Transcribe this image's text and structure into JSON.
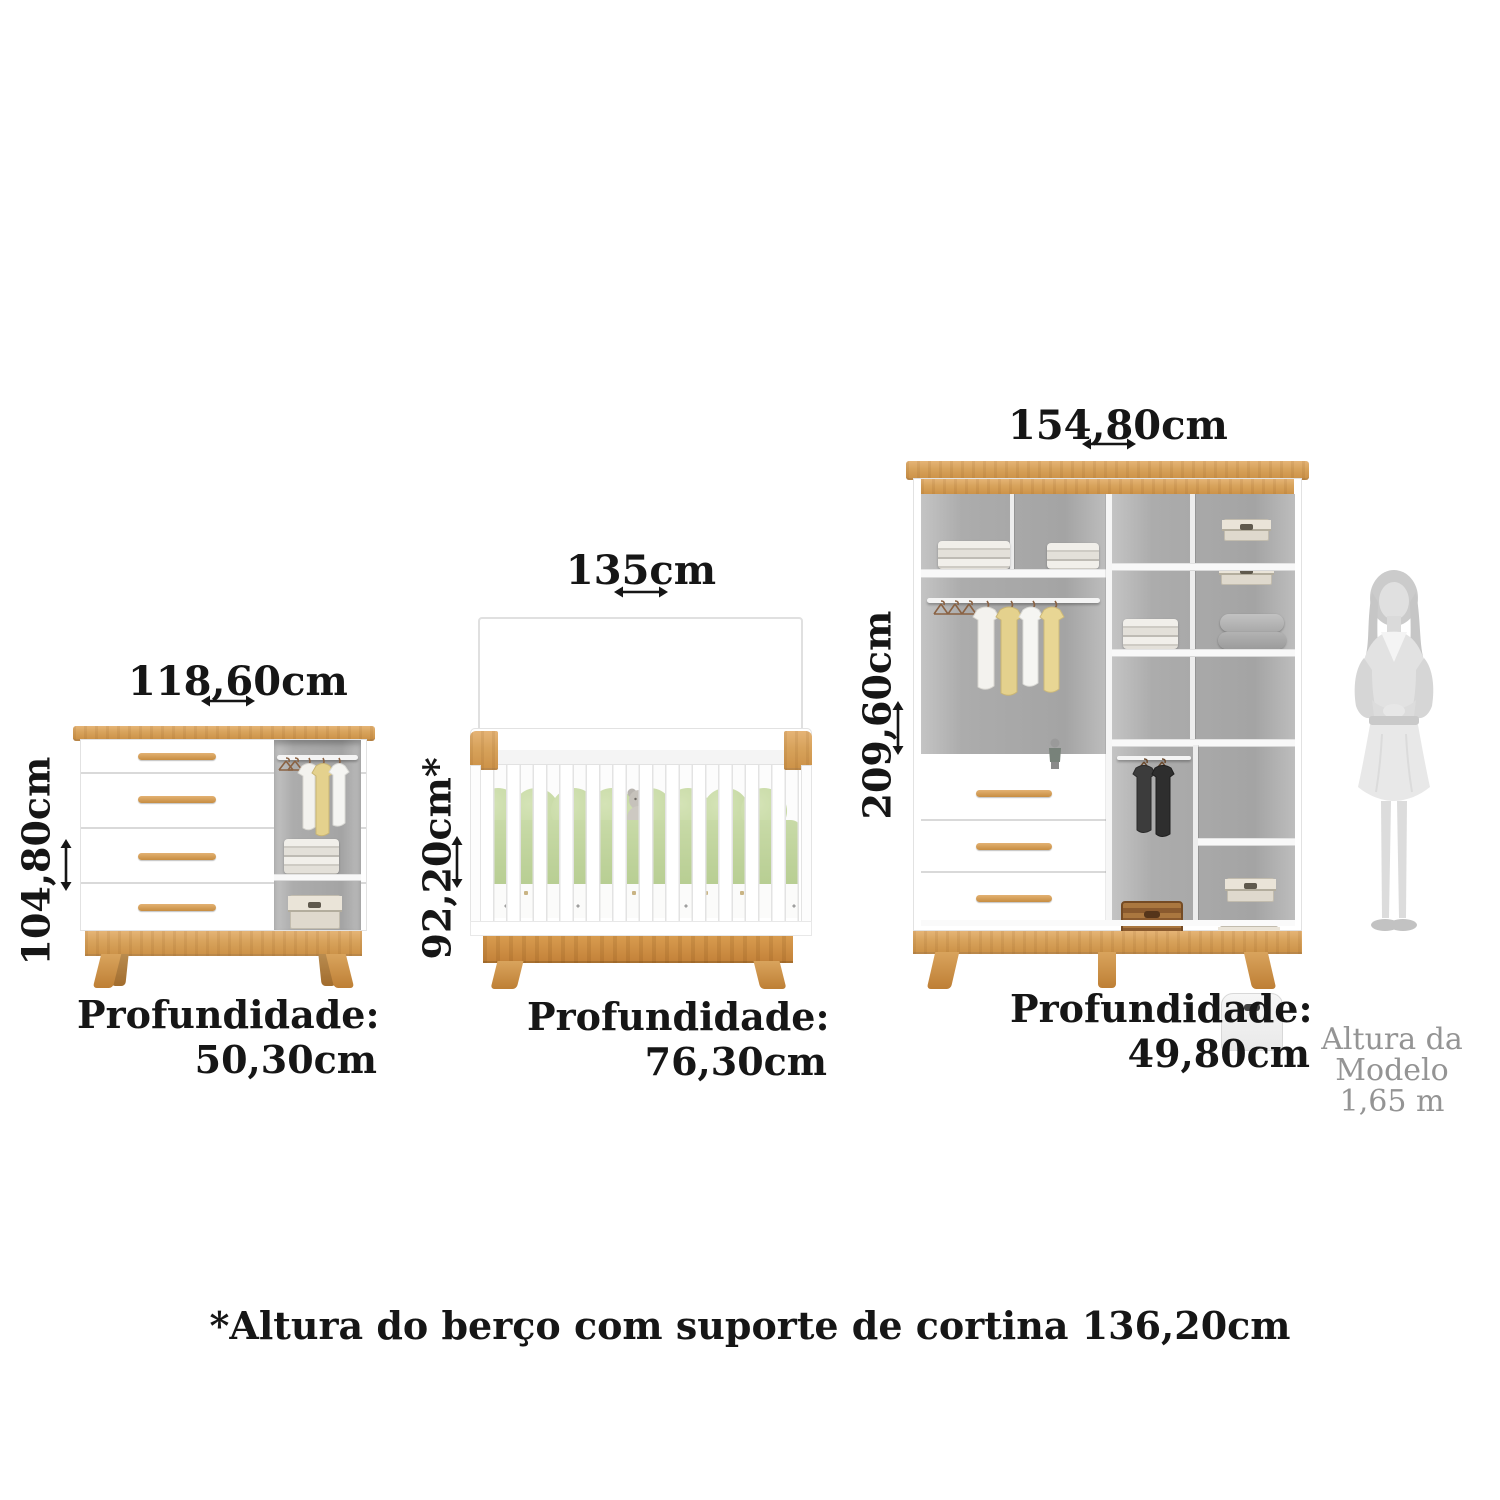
{
  "diagram": {
    "dresser": {
      "width_label": "118,60cm",
      "height_label": "104,80cm",
      "depth_label": "Profundidade:",
      "depth_value": "50,30cm"
    },
    "crib": {
      "width_label": "135cm",
      "height_label": "92,20cm*",
      "depth_label": "Profundidade:",
      "depth_value": "76,30cm"
    },
    "wardrobe": {
      "width_label": "154,80cm",
      "height_label": "209,60cm",
      "depth_label": "Profundidade:",
      "depth_value": "49,80cm"
    },
    "model": {
      "caption_lines": [
        "Altura da",
        "Modelo",
        "1,65 m"
      ]
    },
    "footnote": "*Altura do berço com suporte de cortina 136,20cm",
    "colors": {
      "wood_light": "#D8A35C",
      "wood_dark": "#C4833A",
      "interior_gray": "#ABABAB",
      "bedding_green": "#C5D8A4",
      "label_black": "#161616",
      "caption_gray": "#949494"
    }
  }
}
